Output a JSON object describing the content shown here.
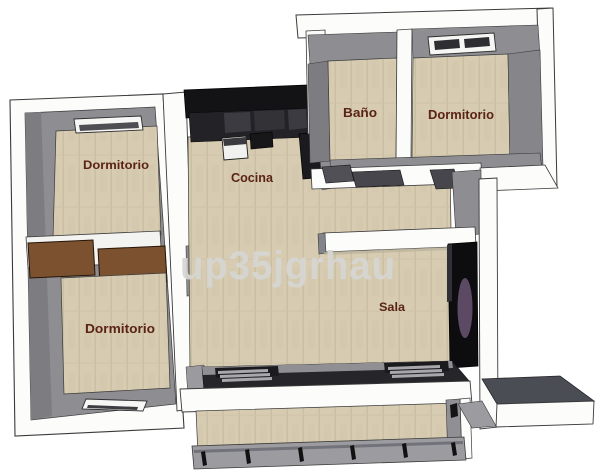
{
  "scene": {
    "description": "3D rendered apartment floor plan, top-down axonometric view",
    "watermark": "up35jgrhau"
  },
  "rooms": {
    "bedroom_top_left": {
      "label": "Dormitorio"
    },
    "bedroom_bottom_left": {
      "label": "Dormitorio"
    },
    "kitchen": {
      "label": "Cocina"
    },
    "bathroom": {
      "label": "Baño"
    },
    "bedroom_top_right": {
      "label": "Dormitorio"
    },
    "living_room": {
      "label": "Sala"
    }
  },
  "colors": {
    "background": "#ffffff",
    "outer_wall": "#fcfcfb",
    "wall_top_gray": "#8d8d92",
    "wall_side_gray": "#7c7c81",
    "floor_wood": "#d7ccb2",
    "kitchen_counter": "#131316",
    "closet_wood": "#7b5130",
    "room_label": "#5a2315",
    "watermark_gray": "#d6d6d3",
    "media_wall": "#0d0d0f",
    "accent_oval_purple": "#5c4964",
    "railing_gray": "#9b9ba0",
    "slab_top_gray": "#4a4d53"
  }
}
